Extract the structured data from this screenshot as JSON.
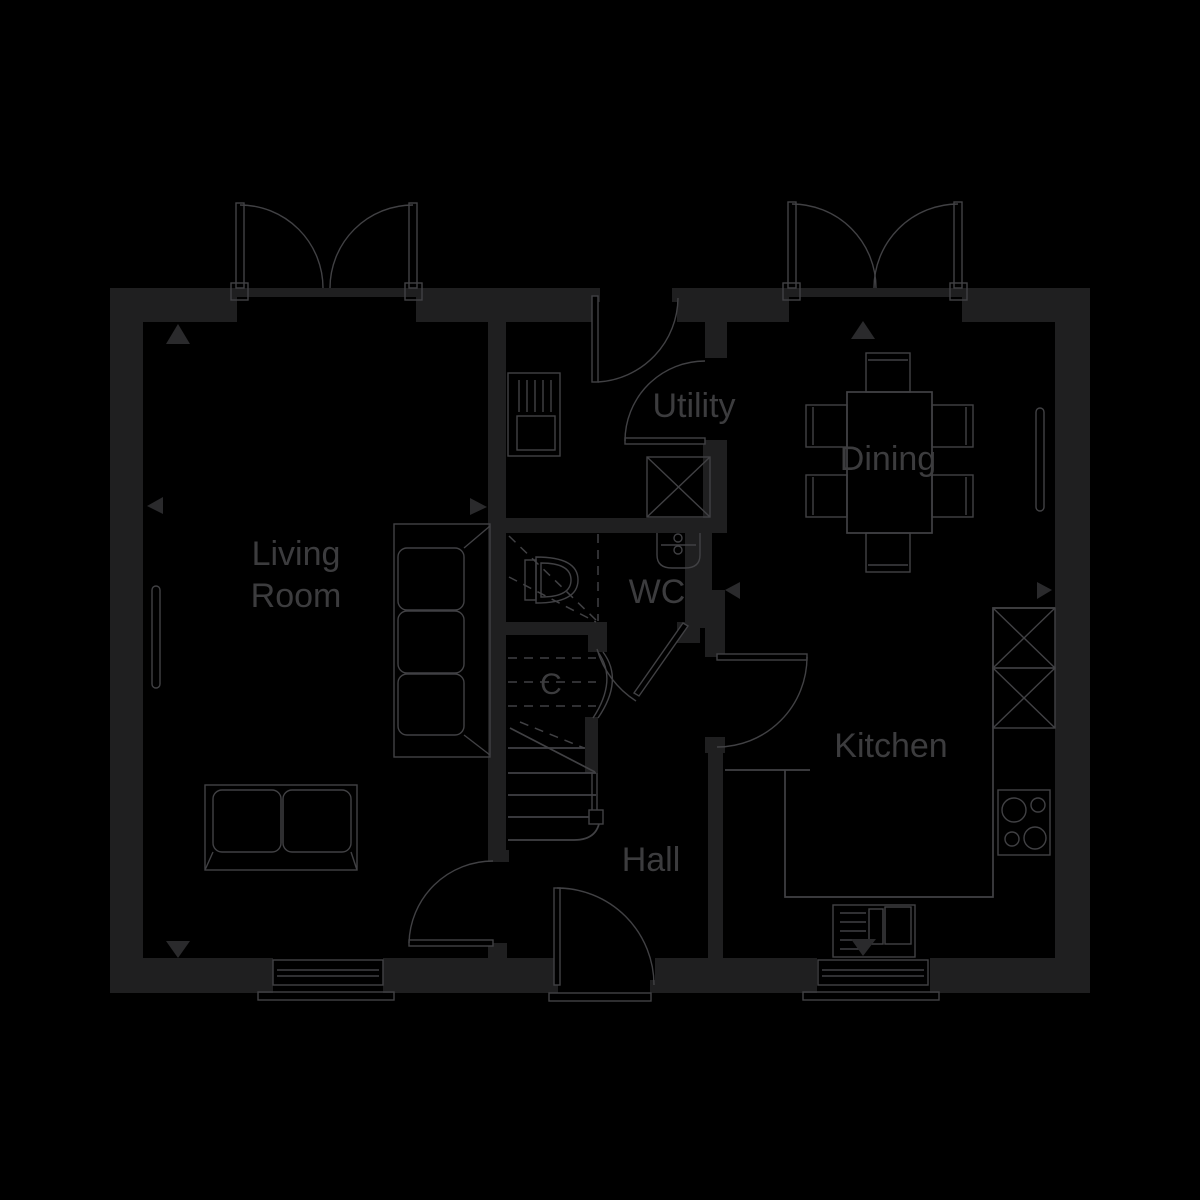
{
  "floor_plan": {
    "type": "ground-floor-plan",
    "colors": {
      "background": "#000000",
      "walls": "#1f1f20",
      "lines": "#414144",
      "text": "#3c3c3e"
    },
    "rooms": {
      "living_room": {
        "label_line1": "Living",
        "label_line2": "Room"
      },
      "utility": {
        "label": "Utility"
      },
      "dining": {
        "label": "Dining"
      },
      "wc": {
        "label": "WC"
      },
      "kitchen": {
        "label": "Kitchen"
      },
      "hall": {
        "label": "Hall"
      },
      "cupboard": {
        "label": "C"
      }
    },
    "features": [
      "french-doors-living-room",
      "french-doors-dining",
      "back-door-utility",
      "front-door",
      "internal-doors",
      "staircase",
      "under-stairs-cupboard",
      "toilet",
      "wash-basin",
      "utility-sink-unit",
      "appliance-space-utility",
      "appliance-spaces-kitchen",
      "hob",
      "kitchen-sink",
      "worktop",
      "dining-table-with-six-chairs",
      "three-seat-sofa",
      "two-seat-sofa",
      "radiators",
      "windows",
      "dimension-arrows"
    ]
  }
}
